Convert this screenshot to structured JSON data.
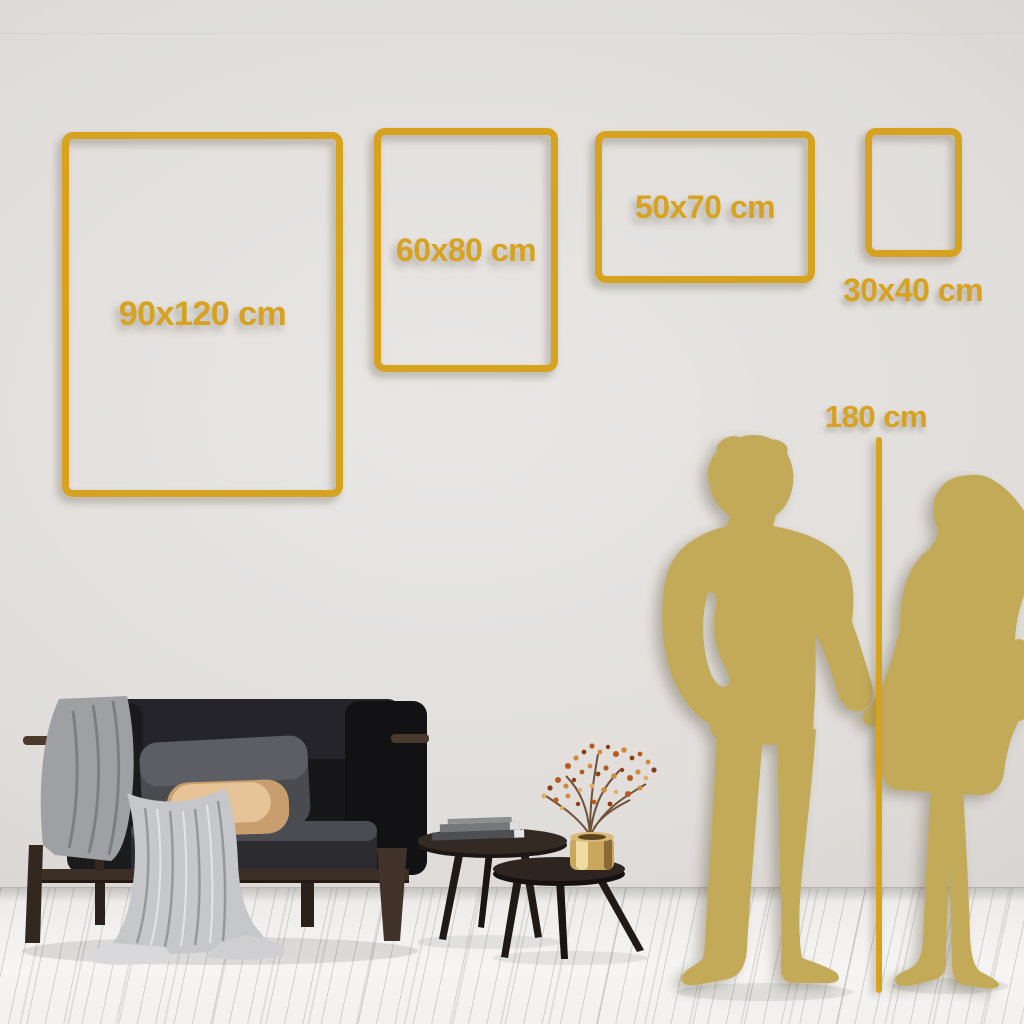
{
  "guide": {
    "frames": [
      {
        "name": "frame-90x120",
        "label": "90x120 cm"
      },
      {
        "name": "frame-60x80",
        "label": "60x80 cm"
      },
      {
        "name": "frame-50x70",
        "label": "50x70 cm"
      },
      {
        "name": "frame-30x40",
        "label": "30x40 cm"
      }
    ],
    "height_reference": {
      "label": "180 cm"
    }
  },
  "colors": {
    "gold_accent": "#D7A21F",
    "silhouette_gold": "#C3AA58"
  },
  "scene": {
    "figures": [
      "man-silhouette",
      "woman-silhouette"
    ],
    "furniture": [
      "sofa",
      "throw-blanket",
      "gray-pillow",
      "beige-pillow",
      "coffee-table-large",
      "coffee-table-small",
      "books",
      "brass-vase",
      "dried-branch"
    ]
  }
}
